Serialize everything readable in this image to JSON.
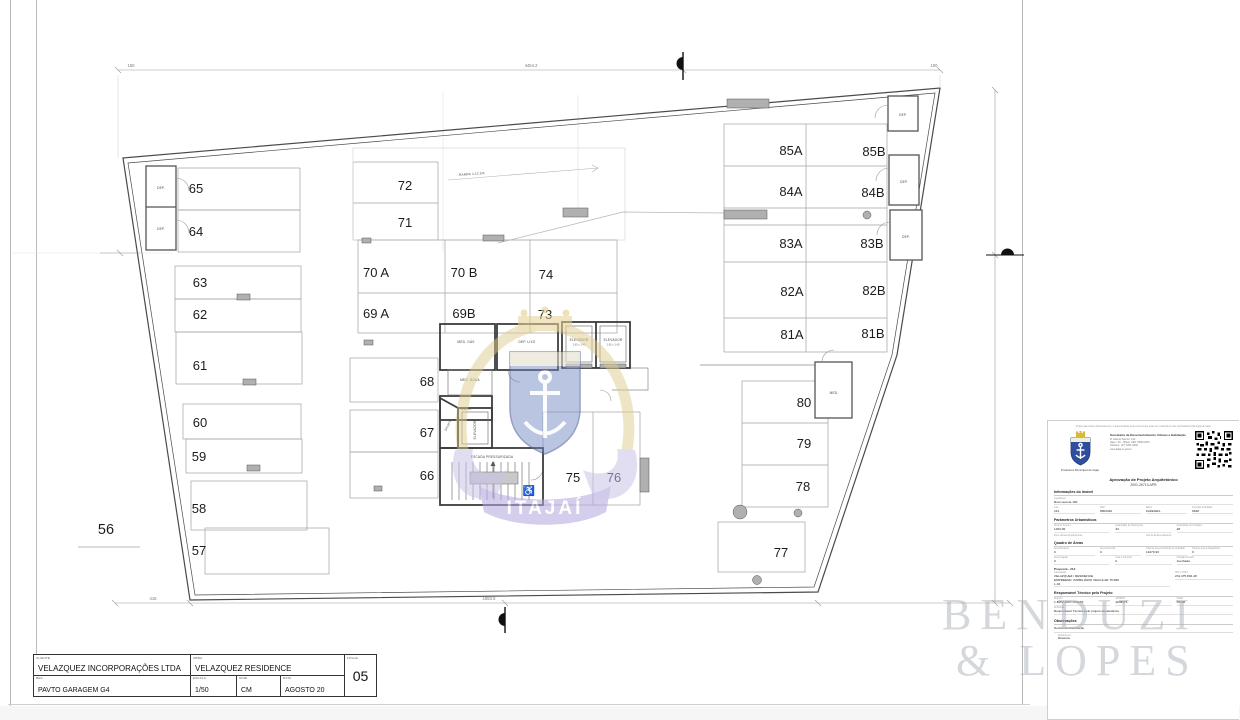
{
  "sheet": {
    "title_block": {
      "cliente_label": "CLIENTE",
      "cliente": "VELAZQUEZ INCORPORAÇÕES LTDA",
      "obra_label": "OBRA",
      "obra": "VELAZQUEZ RESIDENCE",
      "ref_label": "REF.",
      "ref": "PAVTO GARAGEM G4",
      "escala_label": "ESCALA",
      "escala": "1/50",
      "unidade_label": "UNID.",
      "unidade": "CM",
      "data_label": "DATA",
      "data": "AGOSTO 20",
      "folha_label": "FOLHA",
      "folha": "05"
    }
  },
  "watermark": {
    "firm1": "BENDUZI",
    "firm2": "& LOPES",
    "crest_text": "ITAJAÍ"
  },
  "icons": {
    "wheelchair": "♿"
  },
  "plan": {
    "stalls": [
      "65",
      "64",
      "63",
      "62",
      "61",
      "60",
      "59",
      "58",
      "57",
      "56",
      "72",
      "71",
      "70 A",
      "70 B",
      "74",
      "69 A",
      "69B",
      "73",
      "68",
      "67",
      "66",
      "75",
      "76",
      "85A",
      "85B",
      "84A",
      "84B",
      "83A",
      "83B",
      "82A",
      "82B",
      "81A",
      "81B",
      "80",
      "79",
      "78",
      "77"
    ],
    "rooms": [
      "ELEVADOR",
      "1.60 x 1.40",
      "ELEVADOR",
      "1.60 x 1.40",
      "MED. GÁS",
      "DEP. LIXO",
      "MED. ÁGUA",
      "DUTO",
      "ELEVADOR",
      "SHAFT",
      "ESCADA PRESSURIZADA",
      "DEP.",
      "DEP.",
      "DEP.",
      "DEP.",
      "DEP.",
      "MED.",
      "RAMPA i=12,5%"
    ],
    "dims": {
      "t1": "150",
      "t2": "4454.2",
      "t3": "150",
      "b1": "415",
      "b2": "1983.5"
    }
  },
  "panel": {
    "disclaimer": "Projeto aprovado eletronicamente. A autenticidade deste documento pode ser conferida no site da Prefeitura Municipal de Itajaí.",
    "secretaria": "Secretaria de Desenvolvimento Urbano e Habitação",
    "address1": "R. Alberto Werner, 100",
    "address2": "Itajaí - SC - Brasil, CEP: 88304-053",
    "address3": "Telefone: (47) 3341-6000",
    "address4": "www.itajai.sc.gov.br",
    "orgao": "Prefeitura Municipal de Itajaí",
    "approval_title": "Aprovação de Projeto Arquitetônico",
    "approval_number": "2001-26713-APR",
    "sec_imovel": "Informações do Imóvel",
    "logradouro_label": "Logradouro",
    "logradouro": "Rua Laconia 100",
    "f1_label": "Lote",
    "f1": "212",
    "f2_label": "CEP",
    "f2": "8803440",
    "f3_label": "Bairro",
    "f3": "FAZENDA",
    "f4_label": "Inscrição Imobiliária",
    "f4": "9648",
    "sec_param": "Parâmetros Urbanísticos",
    "p1_label": "Área do Terreno",
    "p1": "1463.06",
    "p2_label": "Quantidade de Pavimentos",
    "p2": "34",
    "p3_label": "Quantidade de Unidades",
    "p3": "28",
    "p4_label": "Zona Urbana Predominante",
    "p5_label": "Uso do Empreendimento",
    "sec_areas": "Quadro de Áreas",
    "a1_label": "Área Existente",
    "a1": "0",
    "a2_label": "Área a Demolir",
    "a2": "0",
    "a3_label": "Total de Área Construída ou Ampliada",
    "a3": "14279.93",
    "a4_label": "Total de Área a Regularizar",
    "a4": "0",
    "a5_label": "Área Irregular",
    "a5": "0",
    "a6_label": "Área a Construir",
    "a6": "0",
    "a7_label": "Situação Predial",
    "a7": "Averbada",
    "proposta": "Proposta - 212",
    "prop_nome_label": "Interessado",
    "prop_nome1": "VELAZQUEZ / RESIDENCE",
    "prop_nome2": "EMPREEND. IMOBILIÁRIO VEICULAR 76.588",
    "prop_nome3": "L-04",
    "prop_doc_label": "CPF / CNPJ",
    "prop_doc": "231.475.802-48",
    "sec_resp": "Responsável Técnico pelo Projeto",
    "r1_label": "Registro",
    "r1": "1-BWV-2007-VRU/53",
    "r2_label": "ART/RRT",
    "r2": "4208675",
    "r3_label": "CREA",
    "r3": "55236",
    "r4_label": "Atribuição",
    "r4": "Responsável Técnico pelo projeto arquitetônico",
    "sec_obs": "Observações",
    "obs": "Nenhuma observação",
    "deferido_label": "Deferido por",
    "deferido": "Diretoria"
  }
}
